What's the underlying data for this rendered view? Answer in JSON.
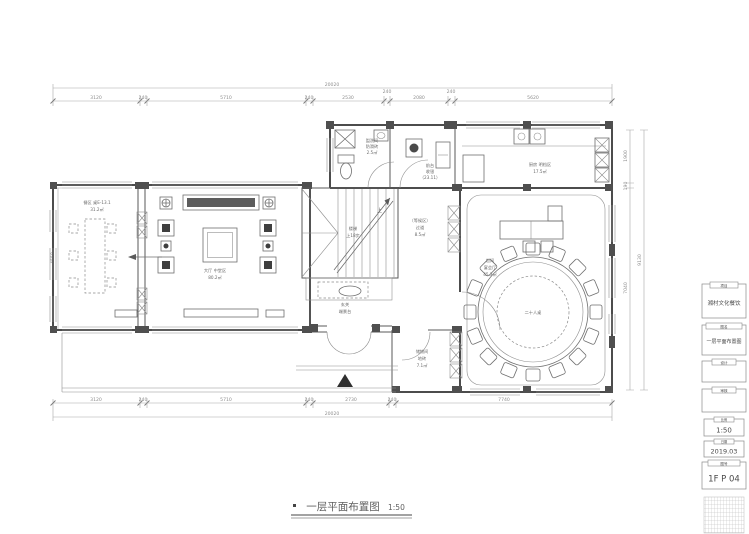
{
  "caption": {
    "title": "一层平面布置图",
    "scale": "1:50"
  },
  "dims": {
    "top_total": "20020",
    "top": [
      "3120",
      "240",
      "5710",
      "240",
      "2530",
      "240",
      "2080",
      "240",
      "5620"
    ],
    "bottom": [
      "3120",
      "240",
      "5710",
      "240",
      "2730",
      "240",
      "7740"
    ],
    "bottom_total": "20020",
    "left": "4550",
    "right": [
      "1900",
      "190",
      "7040"
    ],
    "right_total": "9130"
  },
  "labels": {
    "dining_1": "餐区 桌E-13.1",
    "dining_2": "31.2㎡",
    "hall_1": "大厅 中堂区",
    "hall_2": "80.2㎡",
    "stair_up": "上",
    "stair_1": "楼梯",
    "stair_2": "上18步",
    "foyer_1": "玄关",
    "foyer_2": "端景台",
    "corridor_1": "（等候区）",
    "corridor_2": "过道",
    "corridor_3": "8.5㎡",
    "wc_1": "盥洗间",
    "wc_2": "防滑砖",
    "wc_3": "2.5㎡",
    "office_1": "前台",
    "office_2": "收银",
    "office_3": "（23.11）",
    "kitchen_1": "厨房 明档区",
    "kitchen_2": "17.5㎡",
    "banquet_1": "包间",
    "banquet_2": "宴会厅",
    "banquet_3": "45.3㎡",
    "banquet_table": "二十人桌",
    "storage_1": "储物间",
    "storage_2": "地砖",
    "storage_3": "7.1㎡"
  },
  "titleblock": {
    "b1": {
      "tab": "项目",
      "text": "湘村文化餐饮"
    },
    "b2": {
      "tab": "图名",
      "text": "一层平面布置图"
    },
    "b3": {
      "tab": "设计",
      "text": ""
    },
    "b4": {
      "tab": "审核",
      "text": ""
    },
    "b5": {
      "tab": "比例",
      "text": "1:50"
    },
    "b6": {
      "tab": "日期",
      "text": "2019.03"
    },
    "b7": {
      "tab": "图号",
      "text": "1F P 04"
    }
  }
}
